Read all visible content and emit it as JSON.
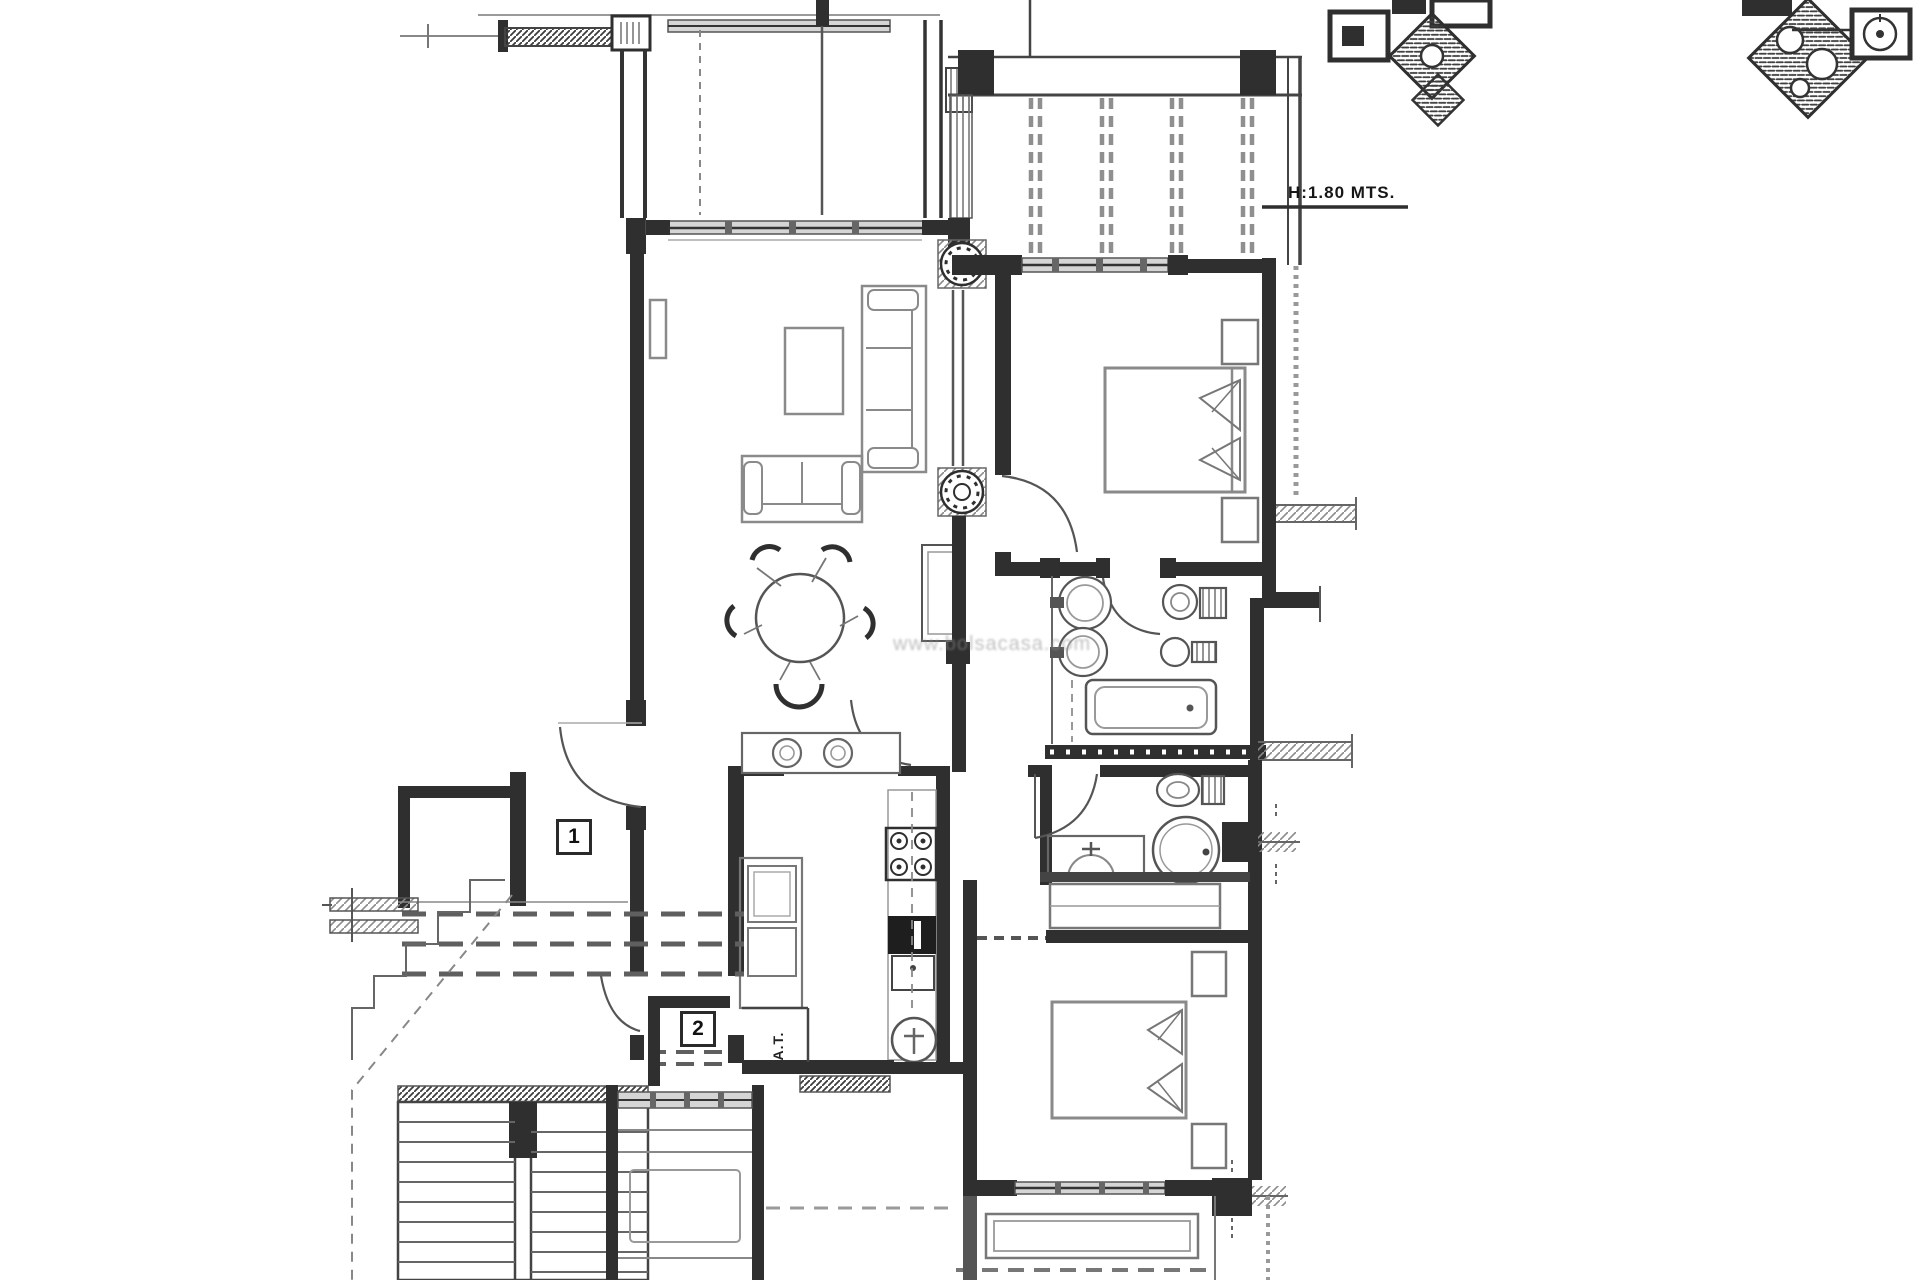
{
  "plan": {
    "height_note": "H:1.80 MTS.",
    "marker_1": "1",
    "marker_2": "2",
    "utility_label": "A.T.",
    "watermark": "www.bolsacasa.com",
    "colors": {
      "ink": "#2f2f2f",
      "wall_gray": "#555555",
      "furniture_gray": "#8a8a8a",
      "window_band": "#d5d5d5",
      "background": "#ffffff"
    },
    "icons": [
      "bed-symbol",
      "bathtub-symbol",
      "washbasin-symbol",
      "toilet-symbol",
      "bidet-symbol",
      "shower-symbol",
      "stove-symbol",
      "sink-symbol",
      "fridge-symbol",
      "boiler-symbol",
      "dining-table-symbol",
      "sofa-symbol",
      "door-arc-symbol",
      "stairs-symbol",
      "pergola-slats-symbol",
      "column-hatch-symbol",
      "planter-symbol",
      "wardrobe-symbol"
    ]
  }
}
